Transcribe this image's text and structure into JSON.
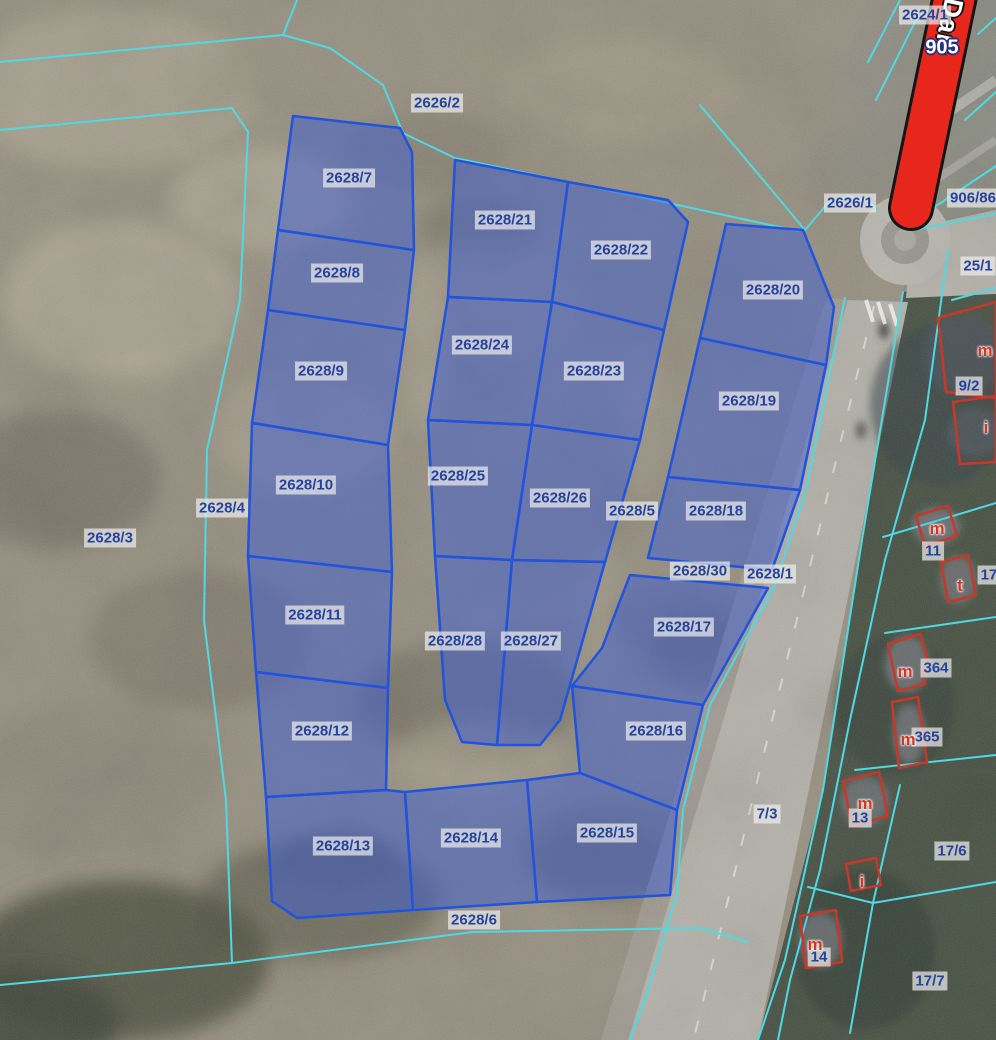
{
  "map": {
    "description": "Cadastral parcel map over aerial orthophoto with highlighted subdivision parcels",
    "width": 996,
    "height": 1040,
    "colors": {
      "boundary_cyan": "#4fd9e3",
      "parcel_fill": "rgba(62,94,212,0.50)",
      "parcel_stroke": "#2153dc",
      "building_stroke": "#c8382a",
      "label_text": "#26439c",
      "label_background": "rgba(238,238,236,0.70)",
      "highlight_road_fill": "#e8271c",
      "highlight_road_outline": "#151515"
    }
  },
  "red_road": {
    "number": "905",
    "number_x": 942,
    "number_y": 48,
    "name": "Darł",
    "name_x": 948,
    "name_y": 26,
    "x1": 957,
    "y1": -14,
    "x2": 911,
    "y2": 208
  },
  "parcels": [
    {
      "id": "2628/7",
      "lx": 349,
      "ly": 178,
      "points": "293,116 400,128 412,152 414,250 278,230"
    },
    {
      "id": "2628/8",
      "lx": 337,
      "ly": 273,
      "points": "278,230 414,250 405,330 268,310"
    },
    {
      "id": "2628/9",
      "lx": 321,
      "ly": 371,
      "points": "268,310 405,330 388,445 252,423"
    },
    {
      "id": "2628/10",
      "lx": 306,
      "ly": 485,
      "points": "252,423 388,445 392,572 248,556"
    },
    {
      "id": "2628/11",
      "lx": 315,
      "ly": 615,
      "points": "248,556 392,572 388,688 256,672"
    },
    {
      "id": "2628/12",
      "lx": 322,
      "ly": 731,
      "points": "256,672 388,688 386,790 266,797"
    },
    {
      "id": "2628/13",
      "lx": 343,
      "ly": 846,
      "points": "266,797 386,790 405,792 413,910 297,918 272,901"
    },
    {
      "id": "2628/21",
      "lx": 505,
      "ly": 220,
      "points": "455,160 568,182 552,302 448,297"
    },
    {
      "id": "2628/24",
      "lx": 482,
      "ly": 345,
      "points": "448,297 552,302 532,425 428,420"
    },
    {
      "id": "2628/25",
      "lx": 458,
      "ly": 476,
      "points": "428,420 532,425 512,560 435,556"
    },
    {
      "id": "2628/28",
      "lx": 455,
      "ly": 641,
      "points": "435,556 512,560 497,745 462,742 445,700"
    },
    {
      "id": "2628/22",
      "lx": 621,
      "ly": 250,
      "points": "568,182 668,200 688,222 664,330 552,302"
    },
    {
      "id": "2628/23",
      "lx": 594,
      "ly": 371,
      "points": "552,302 664,330 640,440 532,425"
    },
    {
      "id": "2628/26",
      "lx": 560,
      "ly": 498,
      "points": "532,425 640,440 605,562 512,560"
    },
    {
      "id": "2628/27",
      "lx": 531,
      "ly": 641,
      "points": "512,560 605,562 560,720 540,745 497,745"
    },
    {
      "id": "2628/20",
      "lx": 773,
      "ly": 290,
      "points": "726,224 803,230 834,307 826,365 700,338"
    },
    {
      "id": "2628/19",
      "lx": 749,
      "ly": 401,
      "points": "700,338 826,365 800,490 668,477"
    },
    {
      "id": "2628/18",
      "lx": 716,
      "ly": 511,
      "points": "668,477 800,490 772,570 648,558"
    },
    {
      "id": "2628/17",
      "lx": 684,
      "ly": 627,
      "points": "630,575 768,588 703,705 572,686 602,648"
    },
    {
      "id": "2628/16",
      "lx": 656,
      "ly": 731,
      "points": "572,686 703,705 677,810 580,773"
    },
    {
      "id": "2628/15",
      "lx": 607,
      "ly": 833,
      "points": "527,780 580,773 677,810 670,895 537,902"
    },
    {
      "id": "2628/14",
      "lx": 471,
      "ly": 838,
      "points": "405,792 527,780 537,902 413,910"
    }
  ],
  "labels": [
    {
      "text": "2624/1",
      "x": 925,
      "y": 15,
      "type": "parcel"
    },
    {
      "text": "2626/2",
      "x": 437,
      "y": 103,
      "type": "parcel"
    },
    {
      "text": "2626/1",
      "x": 850,
      "y": 203,
      "type": "parcel"
    },
    {
      "text": "906/86",
      "x": 973,
      "y": 198,
      "type": "parcel"
    },
    {
      "text": "25/1",
      "x": 978,
      "y": 266,
      "type": "parcel"
    },
    {
      "text": "9/2",
      "x": 969,
      "y": 386,
      "type": "parcel"
    },
    {
      "text": "2628/4",
      "x": 222,
      "y": 508,
      "type": "parcel"
    },
    {
      "text": "2628/3",
      "x": 110,
      "y": 538,
      "type": "parcel"
    },
    {
      "text": "2628/5",
      "x": 632,
      "y": 511,
      "type": "parcel"
    },
    {
      "text": "11",
      "x": 933,
      "y": 551,
      "type": "parcel"
    },
    {
      "text": "17/",
      "x": 991,
      "y": 575,
      "type": "parcel"
    },
    {
      "text": "2628/30",
      "x": 700,
      "y": 571,
      "type": "parcel"
    },
    {
      "text": "2628/1",
      "x": 770,
      "y": 574,
      "type": "parcel"
    },
    {
      "text": "364",
      "x": 936,
      "y": 668,
      "type": "parcel"
    },
    {
      "text": "365",
      "x": 927,
      "y": 737,
      "type": "parcel"
    },
    {
      "text": "7/3",
      "x": 767,
      "y": 814,
      "type": "parcel"
    },
    {
      "text": "13",
      "x": 860,
      "y": 818,
      "type": "parcel"
    },
    {
      "text": "17/6",
      "x": 952,
      "y": 851,
      "type": "parcel"
    },
    {
      "text": "2628/6",
      "x": 474,
      "y": 920,
      "type": "parcel"
    },
    {
      "text": "14",
      "x": 819,
      "y": 957,
      "type": "parcel"
    },
    {
      "text": "17/7",
      "x": 930,
      "y": 981,
      "type": "parcel"
    }
  ],
  "buildings": [
    {
      "letter": "m",
      "letx": 985,
      "lety": 351,
      "points": "938,318 996,302 996,398 946,392"
    },
    {
      "letter": "i",
      "letx": 986,
      "lety": 428,
      "points": "953,402 996,396 996,462 960,464"
    },
    {
      "letter": "m",
      "letx": 937,
      "lety": 529,
      "points": "916,516 948,506 957,536 925,546"
    },
    {
      "letter": "t",
      "letx": 960,
      "lety": 586,
      "points": "941,562 968,555 976,595 948,602"
    },
    {
      "letter": "m",
      "letx": 905,
      "lety": 672,
      "points": "888,644 920,634 930,668 922,671 925,684 898,691"
    },
    {
      "letter": "m",
      "letx": 908,
      "lety": 740,
      "points": "892,702 918,697 927,762 899,768"
    },
    {
      "letter": "m",
      "letx": 865,
      "lety": 804,
      "points": "843,781 879,772 888,816 852,826"
    },
    {
      "letter": "i",
      "letx": 862,
      "lety": 882,
      "points": "846,864 876,858 881,885 851,891"
    },
    {
      "letter": "m",
      "letx": 815,
      "lety": 945,
      "points": "800,916 836,910 842,962 806,968"
    }
  ],
  "boundary_lines": [
    "0,62 283,35 330,48 383,85 403,133 455,158 687,207 798,231",
    "283,35 297,0",
    "700,105 770,188 805,230",
    "0,130 232,108 248,132 240,300 207,450 204,620 226,800 232,963",
    "0,985 232,963 473,932 700,928 748,942",
    "677,893 648,990 630,1040",
    "903,292 862,540 823,790 785,960 758,1040",
    "948,250 925,420 885,560 850,720 820,870 790,980 778,1040",
    "952,300 996,288",
    "883,537 996,503",
    "885,633 996,617",
    "855,770 996,755",
    "900,785 873,903 850,1033",
    "808,887 873,903 996,882",
    "805,230 828,203 848,196 866,200 877,210",
    "845,298 806,490 775,585 710,705 683,810 677,893",
    "918,16 876,100",
    "900,0 868,62",
    "978,34 996,18",
    "965,120 996,92",
    "912,222 996,166",
    "913,230 996,214"
  ],
  "background": {
    "base": "#958f80",
    "blobs": [
      [
        110,
        90,
        150,
        80,
        "#a8a190",
        0.8
      ],
      [
        360,
        60,
        140,
        60,
        "#968f80",
        0.7
      ],
      [
        620,
        90,
        120,
        50,
        "#a39c8b",
        0.6
      ],
      [
        260,
        200,
        90,
        50,
        "#b2ab9a",
        0.65
      ],
      [
        430,
        150,
        80,
        40,
        "#7e796c",
        0.5
      ],
      [
        480,
        230,
        60,
        35,
        "#6f6c5d",
        0.45
      ],
      [
        120,
        300,
        120,
        80,
        "#b0a897",
        0.7
      ],
      [
        60,
        480,
        100,
        70,
        "#6e6a5e",
        0.6
      ],
      [
        300,
        430,
        90,
        60,
        "#a79f8e",
        0.6
      ],
      [
        480,
        300,
        100,
        60,
        "#9a9383",
        0.6
      ],
      [
        700,
        300,
        80,
        50,
        "#8f8a7b",
        0.5
      ],
      [
        560,
        520,
        100,
        60,
        "#8e887a",
        0.5
      ],
      [
        425,
        350,
        22,
        90,
        "#aaa392",
        0.55
      ],
      [
        640,
        420,
        20,
        80,
        "#a9a190",
        0.5
      ],
      [
        600,
        600,
        18,
        60,
        "#a9a190",
        0.5
      ],
      [
        200,
        640,
        110,
        70,
        "#7a7568",
        0.6
      ],
      [
        540,
        640,
        80,
        50,
        "#9b9484",
        0.5
      ],
      [
        680,
        620,
        70,
        40,
        "#7f7a6e",
        0.5
      ],
      [
        470,
        700,
        110,
        60,
        "#6d685c",
        0.55
      ],
      [
        480,
        760,
        90,
        40,
        "#a59d8c",
        0.6
      ],
      [
        90,
        780,
        130,
        80,
        "#8a8477",
        0.6
      ],
      [
        320,
        900,
        120,
        60,
        "#5c5c4e",
        0.6
      ],
      [
        340,
        860,
        60,
        30,
        "#5a5c4e",
        0.5
      ],
      [
        600,
        860,
        70,
        35,
        "#565847",
        0.5
      ],
      [
        700,
        650,
        50,
        40,
        "#5f6152",
        0.45
      ],
      [
        620,
        850,
        100,
        50,
        "#77725f",
        0.5
      ],
      [
        120,
        960,
        150,
        80,
        "#4f5243",
        0.85
      ],
      [
        20,
        1020,
        100,
        50,
        "#454a3c",
        0.9
      ],
      [
        905,
        80,
        60,
        80,
        "#8e8c84",
        0.85
      ],
      [
        855,
        170,
        50,
        45,
        "#8a887f",
        0.7
      ],
      [
        982,
        45,
        35,
        50,
        "#90928a",
        0.85
      ]
    ],
    "shapes": [
      {
        "name": "photo-dark-east-area",
        "points": "903,292 862,540 823,790 758,1040 996,1040 996,278",
        "fill": "#424e40",
        "opacity": 0.92
      },
      {
        "name": "photo-urban-top-right",
        "points": "968,0 996,0 996,278 903,292",
        "fill": "#888a80",
        "opacity": 0.95
      },
      {
        "name": "main-road-surface",
        "points": "848,300 908,302 758,1040 628,1040",
        "fill": "#b1afa7",
        "opacity": 1
      },
      {
        "name": "road-shoulder",
        "points": "826,298 848,300 628,1040 601,1040",
        "fill": "#a19e96",
        "opacity": 0.8
      },
      {
        "name": "roundabout-east-arm",
        "points": "912,228 996,210 996,294 906,298",
        "fill": "#b1afa7",
        "opacity": 1
      }
    ],
    "slabs": [
      [
        940,
        405,
        70,
        80,
        "#3a444b",
        0.55
      ],
      [
        895,
        705,
        60,
        70,
        "#3b453e",
        0.6
      ],
      [
        865,
        950,
        70,
        80,
        "#364039",
        0.6
      ],
      [
        962,
        355,
        40,
        40,
        "#49535a",
        0.9
      ],
      [
        975,
        432,
        28,
        24,
        "#4e585f",
        0.9
      ],
      [
        936,
        526,
        24,
        18,
        "#6f7577",
        0.95
      ],
      [
        958,
        580,
        18,
        24,
        "#6a7072",
        0.95
      ],
      [
        907,
        664,
        22,
        28,
        "#6c7274",
        0.95
      ],
      [
        909,
        734,
        16,
        30,
        "#6c7274",
        0.95
      ],
      [
        865,
        801,
        24,
        24,
        "#677072",
        0.95
      ],
      [
        820,
        940,
        22,
        28,
        "#677072",
        0.95
      ],
      [
        884,
        330,
        5,
        9,
        "#3a3d3f",
        0.9
      ],
      [
        861,
        430,
        5,
        9,
        "#44474a",
        0.8
      ]
    ],
    "roundabout": {
      "cx": 905,
      "cy": 240,
      "r_outer": 45,
      "r_ring": 24,
      "r_island": 11,
      "fill_outer": "#b6b4ac",
      "fill_ring": "#97958d",
      "fill_island": "#a8a69e"
    },
    "road_lines": [
      {
        "x1": 874,
        "y1": 306,
        "x2": 694,
        "y2": 1038,
        "stroke": "#e8e6de",
        "w": 2,
        "dash": "12 20",
        "op": 0.7
      },
      {
        "x1": 866,
        "y1": 300,
        "x2": 873,
        "y2": 322,
        "stroke": "#f2f0e8",
        "w": 4,
        "dash": "",
        "op": 0.85
      },
      {
        "x1": 878,
        "y1": 302,
        "x2": 885,
        "y2": 324,
        "stroke": "#f2f0e8",
        "w": 4,
        "dash": "",
        "op": 0.85
      },
      {
        "x1": 890,
        "y1": 304,
        "x2": 897,
        "y2": 326,
        "stroke": "#f2f0e8",
        "w": 4,
        "dash": "",
        "op": 0.85
      },
      {
        "x1": 940,
        "y1": 118,
        "x2": 996,
        "y2": 80,
        "stroke": "#b3b1a9",
        "w": 10,
        "dash": "",
        "op": 0.9
      },
      {
        "x1": 920,
        "y1": 190,
        "x2": 996,
        "y2": 140,
        "stroke": "#a9a79f",
        "w": 8,
        "dash": "",
        "op": 0.8
      }
    ]
  }
}
